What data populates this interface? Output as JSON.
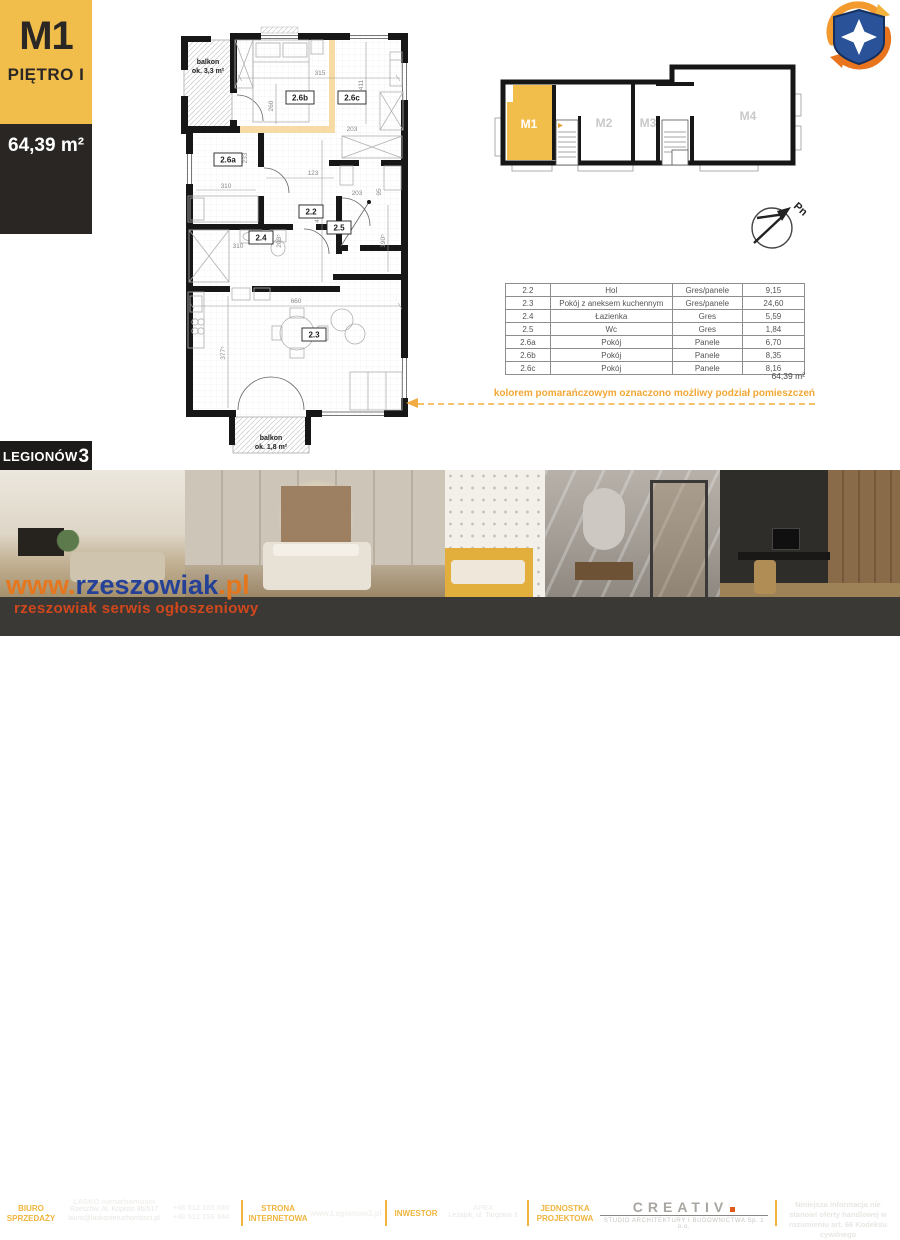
{
  "badge": {
    "unit": "M1",
    "floor": "PIĘTRO I",
    "area": "64,39 m²"
  },
  "building": {
    "name": "LEGIONÓW",
    "number": "3"
  },
  "overview": {
    "m1": "M1",
    "m2": "M2",
    "m3": "M3",
    "m4": "M4"
  },
  "compass": {
    "north": "Pn"
  },
  "floorplan": {
    "balcony_top_line1": "balkon",
    "balcony_top_line2": "ok. 3,3 m²",
    "balcony_bottom_line1": "balkon",
    "balcony_bottom_line2": "ok. 1,8 m²",
    "rooms": {
      "r22": "2.2",
      "r23": "2.3",
      "r24": "2.4",
      "r25": "2.5",
      "r26a": "2.6a",
      "r26b": "2.6b",
      "r26c": "2.6c"
    },
    "dims": {
      "d315": "315",
      "d411": "411",
      "d260": "260",
      "d203a": "203",
      "d233": "233",
      "d310a": "310",
      "d123": "123",
      "d203b": "203",
      "d95": "95",
      "d310b": "310",
      "d2035": "203⁵",
      "d4325": "432⁵",
      "d1905": "190⁵",
      "d660": "660",
      "d3775": "377⁵"
    }
  },
  "table": {
    "rows": [
      {
        "code": "2.2",
        "name": "Hol",
        "flooring": "Gres/panele",
        "area": "9,15"
      },
      {
        "code": "2.3",
        "name": "Pokój z aneksem kuchennym",
        "flooring": "Gres/panele",
        "area": "24,60"
      },
      {
        "code": "2.4",
        "name": "Łazienka",
        "flooring": "Gres",
        "area": "5,59"
      },
      {
        "code": "2.5",
        "name": "Wc",
        "flooring": "Gres",
        "area": "1,84"
      },
      {
        "code": "2.6a",
        "name": "Pokój",
        "flooring": "Panele",
        "area": "6,70"
      },
      {
        "code": "2.6b",
        "name": "Pokój",
        "flooring": "Panele",
        "area": "8,35"
      },
      {
        "code": "2.6c",
        "name": "Pokój",
        "flooring": "Panele",
        "area": "8,16"
      }
    ],
    "total": "64,39 m²"
  },
  "annotation": "kolorem pomarańczowym oznaczono możliwy podział pomieszczeń",
  "footer": {
    "office_label": "BIURO SPRZEDAŻY",
    "office_name": "LASKO nieruchomości",
    "office_address": "Rzeszów, Al. Kopisto 8b/517",
    "office_email": "biuro@laskonieruchomosci.pl",
    "phone1": "+48 512 155 880",
    "phone2": "+48 512 155 844",
    "website_label": "STRONA INTERNETOWA",
    "website": "www.Legionow3.pl",
    "investor_label": "INWESTOR",
    "investor_name": "APEX",
    "investor_address": "Leżajsk, ul. Targowa 3",
    "design_label": "JEDNOSTKA PROJEKTOWA",
    "design_name": "CREATIV",
    "design_sub": "STUDIO ARCHITEKTURY I BUDOWNICTWA Sp. z o.o.",
    "legal": "Niniejsza informacja nie stanowi oferty handlowej w rozumieniu art. 66 Kodeksu cywilnego"
  },
  "watermark": {
    "www": "www.",
    "name": "rzeszowiak",
    "tld": ".pl",
    "tagline": "rzeszowiak serwis ogłoszeniowy"
  },
  "colors": {
    "accent": "#F2BE4B",
    "dark": "#292624",
    "footer_bg": "#3B3936",
    "orange_text": "#F2A735",
    "watermark_blue": "#1E3D99",
    "watermark_orange": "#E8751A"
  }
}
